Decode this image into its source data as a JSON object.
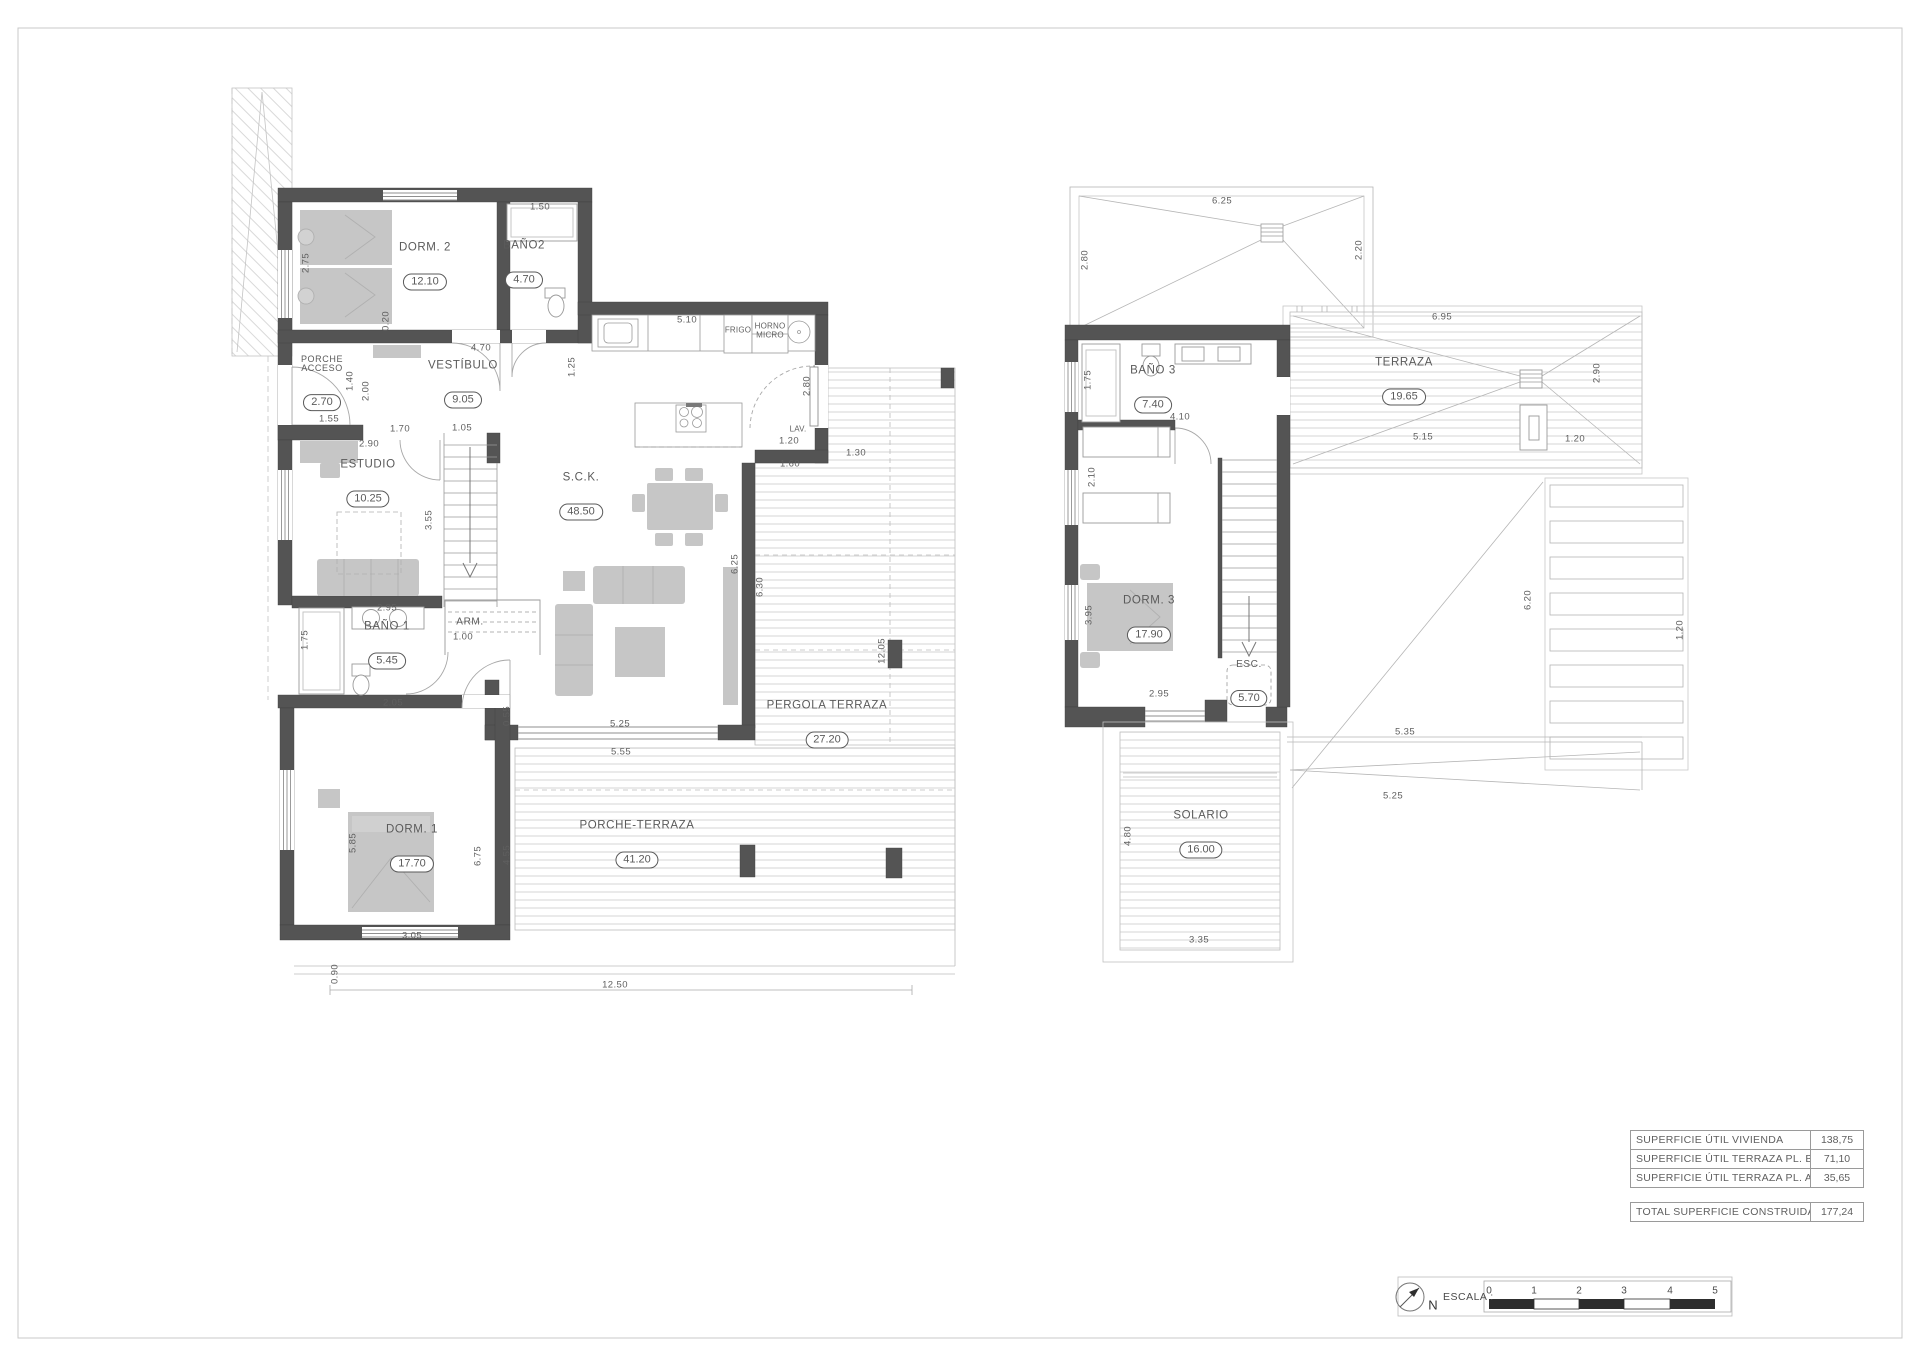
{
  "sheet": {
    "border_color": "#c9c9c9",
    "wall_color": "#545454",
    "accent_text": "#5a5a5a"
  },
  "ground_floor": {
    "rooms": [
      {
        "label": "DORM. 2",
        "area": "12.10"
      },
      {
        "label": "BAÑO2",
        "area": "4.70"
      },
      {
        "label": "VESTÍBULO",
        "area": "9.05"
      },
      {
        "label": "PORCHE ACCESO",
        "area": "2.70"
      },
      {
        "label": "ESTUDIO",
        "area": "10.25"
      },
      {
        "label": "BAÑO 1",
        "area": "5.45"
      },
      {
        "label": "ARM."
      },
      {
        "label": "S.C.K.",
        "area": "48.50"
      },
      {
        "label": "DORM. 1",
        "area": "17.70"
      },
      {
        "label": "PERGOLA TERRAZA",
        "area": "27.20"
      },
      {
        "label": "PORCHE-TERRAZA",
        "area": "41.20"
      }
    ],
    "texts": [
      {
        "t": "1.50",
        "x": 540,
        "y": 207
      },
      {
        "t": "2.75",
        "x": 306,
        "y": 263,
        "v": 1
      },
      {
        "t": "0.20",
        "x": 386,
        "y": 321,
        "v": 1
      },
      {
        "t": "4.70",
        "x": 481,
        "y": 348
      },
      {
        "t": "1.25",
        "x": 572,
        "y": 367,
        "v": 1
      },
      {
        "t": "5.10",
        "x": 687,
        "y": 320
      },
      {
        "t": "2.80",
        "x": 807,
        "y": 386,
        "v": 1
      },
      {
        "t": "LAV.",
        "x": 798,
        "y": 429
      },
      {
        "t": "1.20",
        "x": 789,
        "y": 441
      },
      {
        "t": "1.60",
        "x": 790,
        "y": 464
      },
      {
        "t": "1.30",
        "x": 856,
        "y": 453
      },
      {
        "t": "1.55",
        "x": 329,
        "y": 419
      },
      {
        "t": "1.40",
        "x": 350,
        "y": 381,
        "v": 1
      },
      {
        "t": "2.00",
        "x": 366,
        "y": 391,
        "v": 1
      },
      {
        "t": "1.70",
        "x": 400,
        "y": 429
      },
      {
        "t": "2.90",
        "x": 369,
        "y": 444
      },
      {
        "t": "1.05",
        "x": 462,
        "y": 428
      },
      {
        "t": "3.55",
        "x": 429,
        "y": 520,
        "v": 1
      },
      {
        "t": "2.95",
        "x": 387,
        "y": 608
      },
      {
        "t": "1.75",
        "x": 305,
        "y": 640,
        "v": 1
      },
      {
        "t": "1.00",
        "x": 463,
        "y": 637
      },
      {
        "t": "2.05",
        "x": 393,
        "y": 703
      },
      {
        "t": "0.55",
        "x": 507,
        "y": 716,
        "v": 1
      },
      {
        "t": "5.25",
        "x": 620,
        "y": 724
      },
      {
        "t": "5.55",
        "x": 621,
        "y": 752
      },
      {
        "t": "6.25",
        "x": 735,
        "y": 564,
        "v": 1
      },
      {
        "t": "6.30",
        "x": 760,
        "y": 587,
        "v": 1
      },
      {
        "t": "12.05",
        "x": 882,
        "y": 651,
        "v": 1
      },
      {
        "t": "5.85",
        "x": 353,
        "y": 843,
        "v": 1
      },
      {
        "t": "6.75",
        "x": 478,
        "y": 856,
        "v": 1
      },
      {
        "t": "4.55",
        "x": 507,
        "y": 855,
        "v": 1
      },
      {
        "t": "3.05",
        "x": 412,
        "y": 936
      },
      {
        "t": "0.90",
        "x": 335,
        "y": 974,
        "v": 1
      },
      {
        "t": "12.50",
        "x": 615,
        "y": 985
      },
      {
        "t": "FRIGO",
        "x": 738,
        "y": 330
      },
      {
        "t": "HORNO",
        "x": 770,
        "y": 326
      },
      {
        "t": "MICRO",
        "x": 770,
        "y": 335
      }
    ]
  },
  "upper_floor": {
    "rooms": [
      {
        "label": "BAÑO 3",
        "area": "7.40"
      },
      {
        "label": "TERRAZA",
        "area": "19.65"
      },
      {
        "label": "DORM. 3",
        "area": "17.90"
      },
      {
        "label": "ESC.",
        "area": "5.70"
      },
      {
        "label": "SOLARIO",
        "area": "16.00"
      }
    ],
    "texts": [
      {
        "t": "6.25",
        "x": 1222,
        "y": 201
      },
      {
        "t": "2.80",
        "x": 1085,
        "y": 260,
        "v": 1
      },
      {
        "t": "2.20",
        "x": 1359,
        "y": 250,
        "v": 1
      },
      {
        "t": "6.95",
        "x": 1442,
        "y": 317
      },
      {
        "t": "2.90",
        "x": 1597,
        "y": 373,
        "v": 1
      },
      {
        "t": "1.75",
        "x": 1088,
        "y": 380,
        "v": 1
      },
      {
        "t": "4.10",
        "x": 1180,
        "y": 417
      },
      {
        "t": "5.15",
        "x": 1423,
        "y": 437
      },
      {
        "t": "1.20",
        "x": 1575,
        "y": 439
      },
      {
        "t": "2.10",
        "x": 1092,
        "y": 477,
        "v": 1
      },
      {
        "t": "3.95",
        "x": 1089,
        "y": 615,
        "v": 1
      },
      {
        "t": "2.95",
        "x": 1159,
        "y": 694
      },
      {
        "t": "1.05",
        "x": 1244,
        "y": 703
      },
      {
        "t": "5.35",
        "x": 1405,
        "y": 732
      },
      {
        "t": "6.20",
        "x": 1528,
        "y": 600,
        "v": 1
      },
      {
        "t": "5.25",
        "x": 1393,
        "y": 796
      },
      {
        "t": "4.80",
        "x": 1128,
        "y": 836,
        "v": 1
      },
      {
        "t": "3.35",
        "x": 1199,
        "y": 940
      },
      {
        "t": "1.20",
        "x": 1680,
        "y": 630,
        "v": 1
      }
    ]
  },
  "areas_table": {
    "rows": [
      {
        "label": "SUPERFICIE ÚTIL VIVIENDA",
        "value": "138,75"
      },
      {
        "label": "SUPERFICIE ÚTIL TERRAZA PL. BAJA",
        "value": "71,10"
      },
      {
        "label": "SUPERFICIE ÚTIL TERRAZA PL. ALTA",
        "value": "35,65"
      }
    ],
    "total": {
      "label": "TOTAL SUPERFICIE CONSTRUIDA",
      "value": "177,24"
    }
  },
  "scale_bar": {
    "label": "ESCALA :",
    "north": "N",
    "ticks": [
      "0",
      "1",
      "2",
      "3",
      "4",
      "5"
    ]
  }
}
